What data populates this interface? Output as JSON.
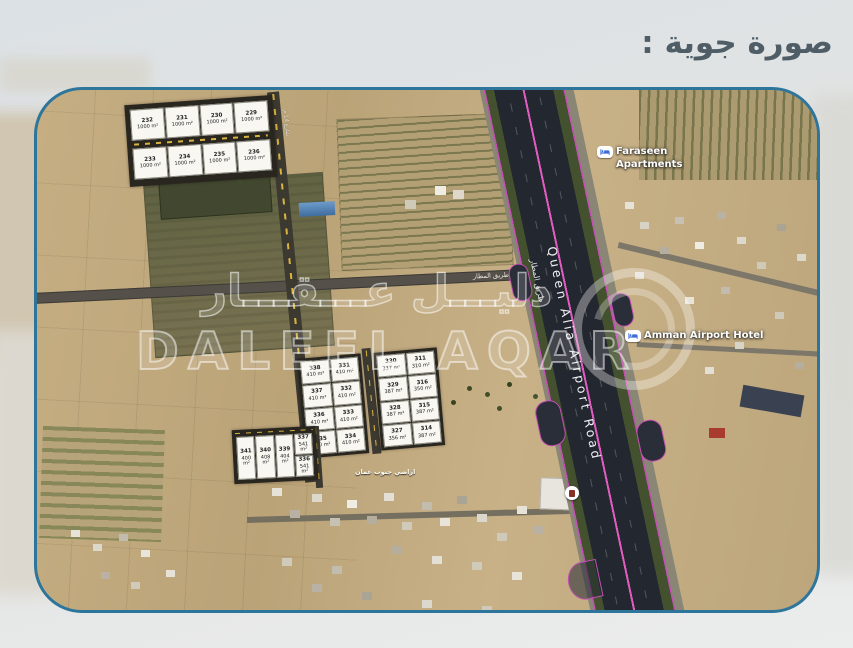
{
  "page": {
    "title": "صورة جوية :"
  },
  "colors": {
    "map_border": "#2e759b",
    "title_text": "#4f5d66",
    "road_dash_yellow": "#d9b53e",
    "highway_overlay_purple": "#c44fb4"
  },
  "map": {
    "watermark": {
      "arabic": "دليـــل عـــقـــار",
      "latin": "DALEEL AQAR"
    },
    "roads": {
      "highway_en": "Queen Alia Airport Road",
      "highway_ar": "طريق المطار",
      "access_label": "300 م عن طريق المطار",
      "street_north": "شارع 14 م",
      "street_mid": "شارع 12 م"
    },
    "pois": {
      "apartments_line1": "Faraseen",
      "apartments_line2": "Apartments",
      "hotel": "Amman Airport Hotel"
    },
    "area_label": "اراضي جنوب عمان",
    "blocks": {
      "north": {
        "cells": [
          {
            "n": "232",
            "a": "1000 m²"
          },
          {
            "n": "231",
            "a": "1000 m²"
          },
          {
            "n": "230",
            "a": "1000 m²"
          },
          {
            "n": "229",
            "a": "1000 m²"
          },
          {
            "n": "233",
            "a": "1000 m²"
          },
          {
            "n": "234",
            "a": "1000 m²"
          },
          {
            "n": "235",
            "a": "1000 m²"
          },
          {
            "n": "236",
            "a": "1000 m²"
          }
        ]
      },
      "mid_left": {
        "cells": [
          {
            "n": "338",
            "a": "410 m²"
          },
          {
            "n": "331",
            "a": "410 m²"
          },
          {
            "n": "337",
            "a": "410 m²"
          },
          {
            "n": "332",
            "a": "410 m²"
          },
          {
            "n": "336",
            "a": "410 m²"
          },
          {
            "n": "333",
            "a": "410 m²"
          },
          {
            "n": "335",
            "a": "400 m²"
          },
          {
            "n": "334",
            "a": "410 m²"
          }
        ]
      },
      "mid_right": {
        "cells": [
          {
            "n": "330",
            "a": "337 m²"
          },
          {
            "n": "311",
            "a": "310 m²"
          },
          {
            "n": "329",
            "a": "387 m²"
          },
          {
            "n": "316",
            "a": "350 m²"
          },
          {
            "n": "328",
            "a": "387 m²"
          },
          {
            "n": "315",
            "a": "387 m²"
          },
          {
            "n": "327",
            "a": "356 m²"
          },
          {
            "n": "314",
            "a": "387 m²"
          }
        ]
      },
      "south": {
        "cells": [
          {
            "n": "341",
            "a": "400 m²"
          },
          {
            "n": "340",
            "a": "408 m²"
          },
          {
            "n": "339",
            "a": "404 m²"
          },
          {
            "n": "337",
            "a": "541 m²"
          },
          {
            "n": "336",
            "a": "541 m²"
          }
        ]
      }
    }
  }
}
